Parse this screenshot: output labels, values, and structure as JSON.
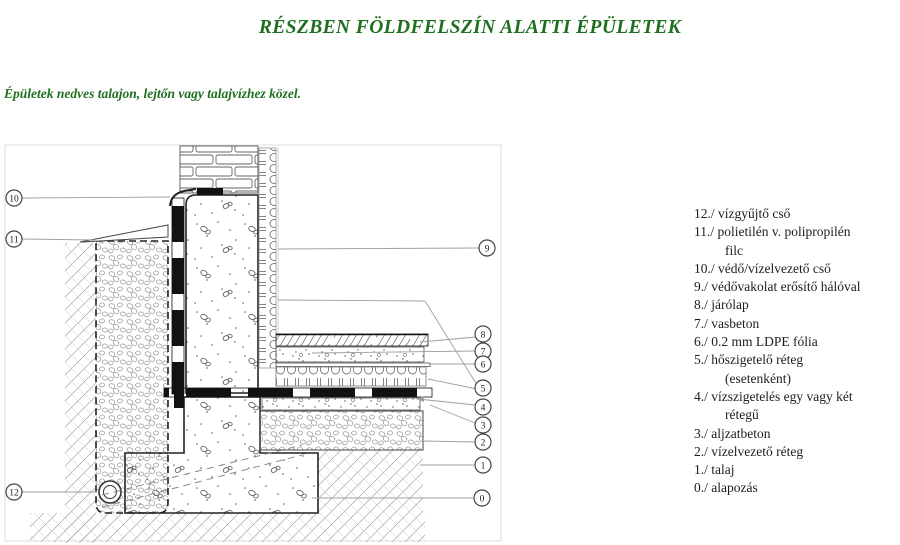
{
  "page": {
    "title": "RÉSZBEN FÖLDFELSZÍN ALATTI ÉPÜLETEK",
    "subtitle": "Épületek nedves talajon, lejtőn vagy talajvízhez közel.",
    "heading_color": "#1e6f1e"
  },
  "legend": {
    "items": [
      {
        "num": "12./",
        "text": "vízgyűjtő cső"
      },
      {
        "num": "11./",
        "text": "polietilén v. polipropilén",
        "cont": "filc"
      },
      {
        "num": "10./",
        "text": "védő/vízelvezető cső"
      },
      {
        "num": "9./",
        "text": "védővakolat erősítő hálóval"
      },
      {
        "num": "8./",
        "text": "járólap"
      },
      {
        "num": "7./",
        "text": "vasbeton"
      },
      {
        "num": "6./",
        "text": "0.2 mm LDPE fólia"
      },
      {
        "num": "5./",
        "text": "hőszigetelő réteg",
        "cont": "(esetenként)"
      },
      {
        "num": "4./",
        "text": "vízszigetelés egy vagy két",
        "cont": "rétegű"
      },
      {
        "num": "3./",
        "text": "aljzatbeton"
      },
      {
        "num": "2./",
        "text": "vízelvezető réteg"
      },
      {
        "num": "1./",
        "text": "talaj"
      },
      {
        "num": "0./",
        "text": "alapozás"
      }
    ]
  },
  "diagram": {
    "callouts": [
      "10",
      "11",
      "12",
      "9",
      "8",
      "7",
      "6",
      "5",
      "4",
      "3",
      "2",
      "1",
      "0"
    ]
  }
}
